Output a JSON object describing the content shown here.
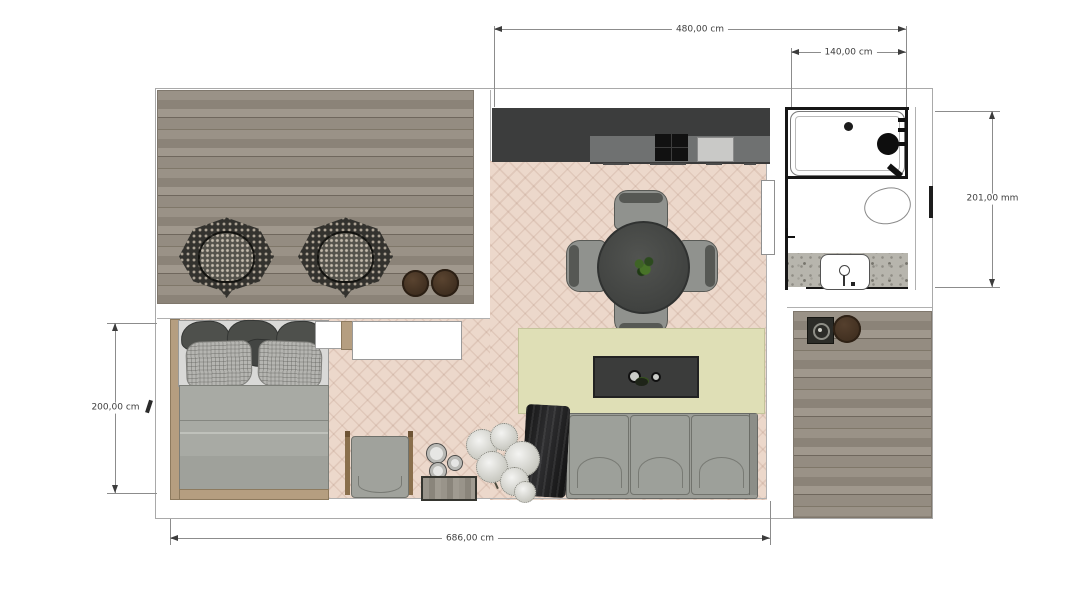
{
  "dimensions": {
    "top": {
      "label": "480,00 cm"
    },
    "top_right": {
      "label": "140,00 cm"
    },
    "right": {
      "label": "201,00 mm"
    },
    "left": {
      "label": "200,00 cm"
    },
    "bottom": {
      "label": "686,00 cm"
    }
  },
  "colors": {
    "outline": "#a9a9a9",
    "wall_black": "#161616",
    "deck_wood": "#8f877c",
    "floor_herringbone": "#ecd8cb",
    "kitchen_dark": "#3c3d3d",
    "kitchen_counter": "#6f7171",
    "rug": "#dfdfb6",
    "sofa": "#9b9d97",
    "coffee_table": "#3b3c3b",
    "terrazzo_floor": "#b7b5ad",
    "pouf_brown": "#4a3729",
    "dimension_text": "#3e3e3e"
  },
  "rooms": {
    "terrace_top_left": {
      "items": [
        "wicker-lounge-chair",
        "wicker-lounge-chair",
        "pouf",
        "pouf"
      ]
    },
    "kitchen": {
      "items": [
        "tall-cabinet",
        "counter",
        "cooktop",
        "kitchen-sink"
      ]
    },
    "bathroom": {
      "items": [
        "bathtub",
        "shower-head",
        "toilet",
        "washbasin"
      ]
    },
    "dining_area": {
      "items": [
        "round-table",
        "dining-chair",
        "dining-chair",
        "dining-chair",
        "dining-chair",
        "table-plant"
      ]
    },
    "living_area": {
      "items": [
        "rug",
        "coffee-table",
        "sofa",
        "throw-blanket",
        "dried-plant",
        "vases",
        "tray"
      ]
    },
    "bedroom": {
      "items": [
        "bed",
        "pillows",
        "duvet",
        "wardrobe",
        "nightstand",
        "rocking-chair"
      ]
    },
    "patio_bottom_right": {
      "items": [
        "fire-pit",
        "side-table"
      ]
    }
  }
}
